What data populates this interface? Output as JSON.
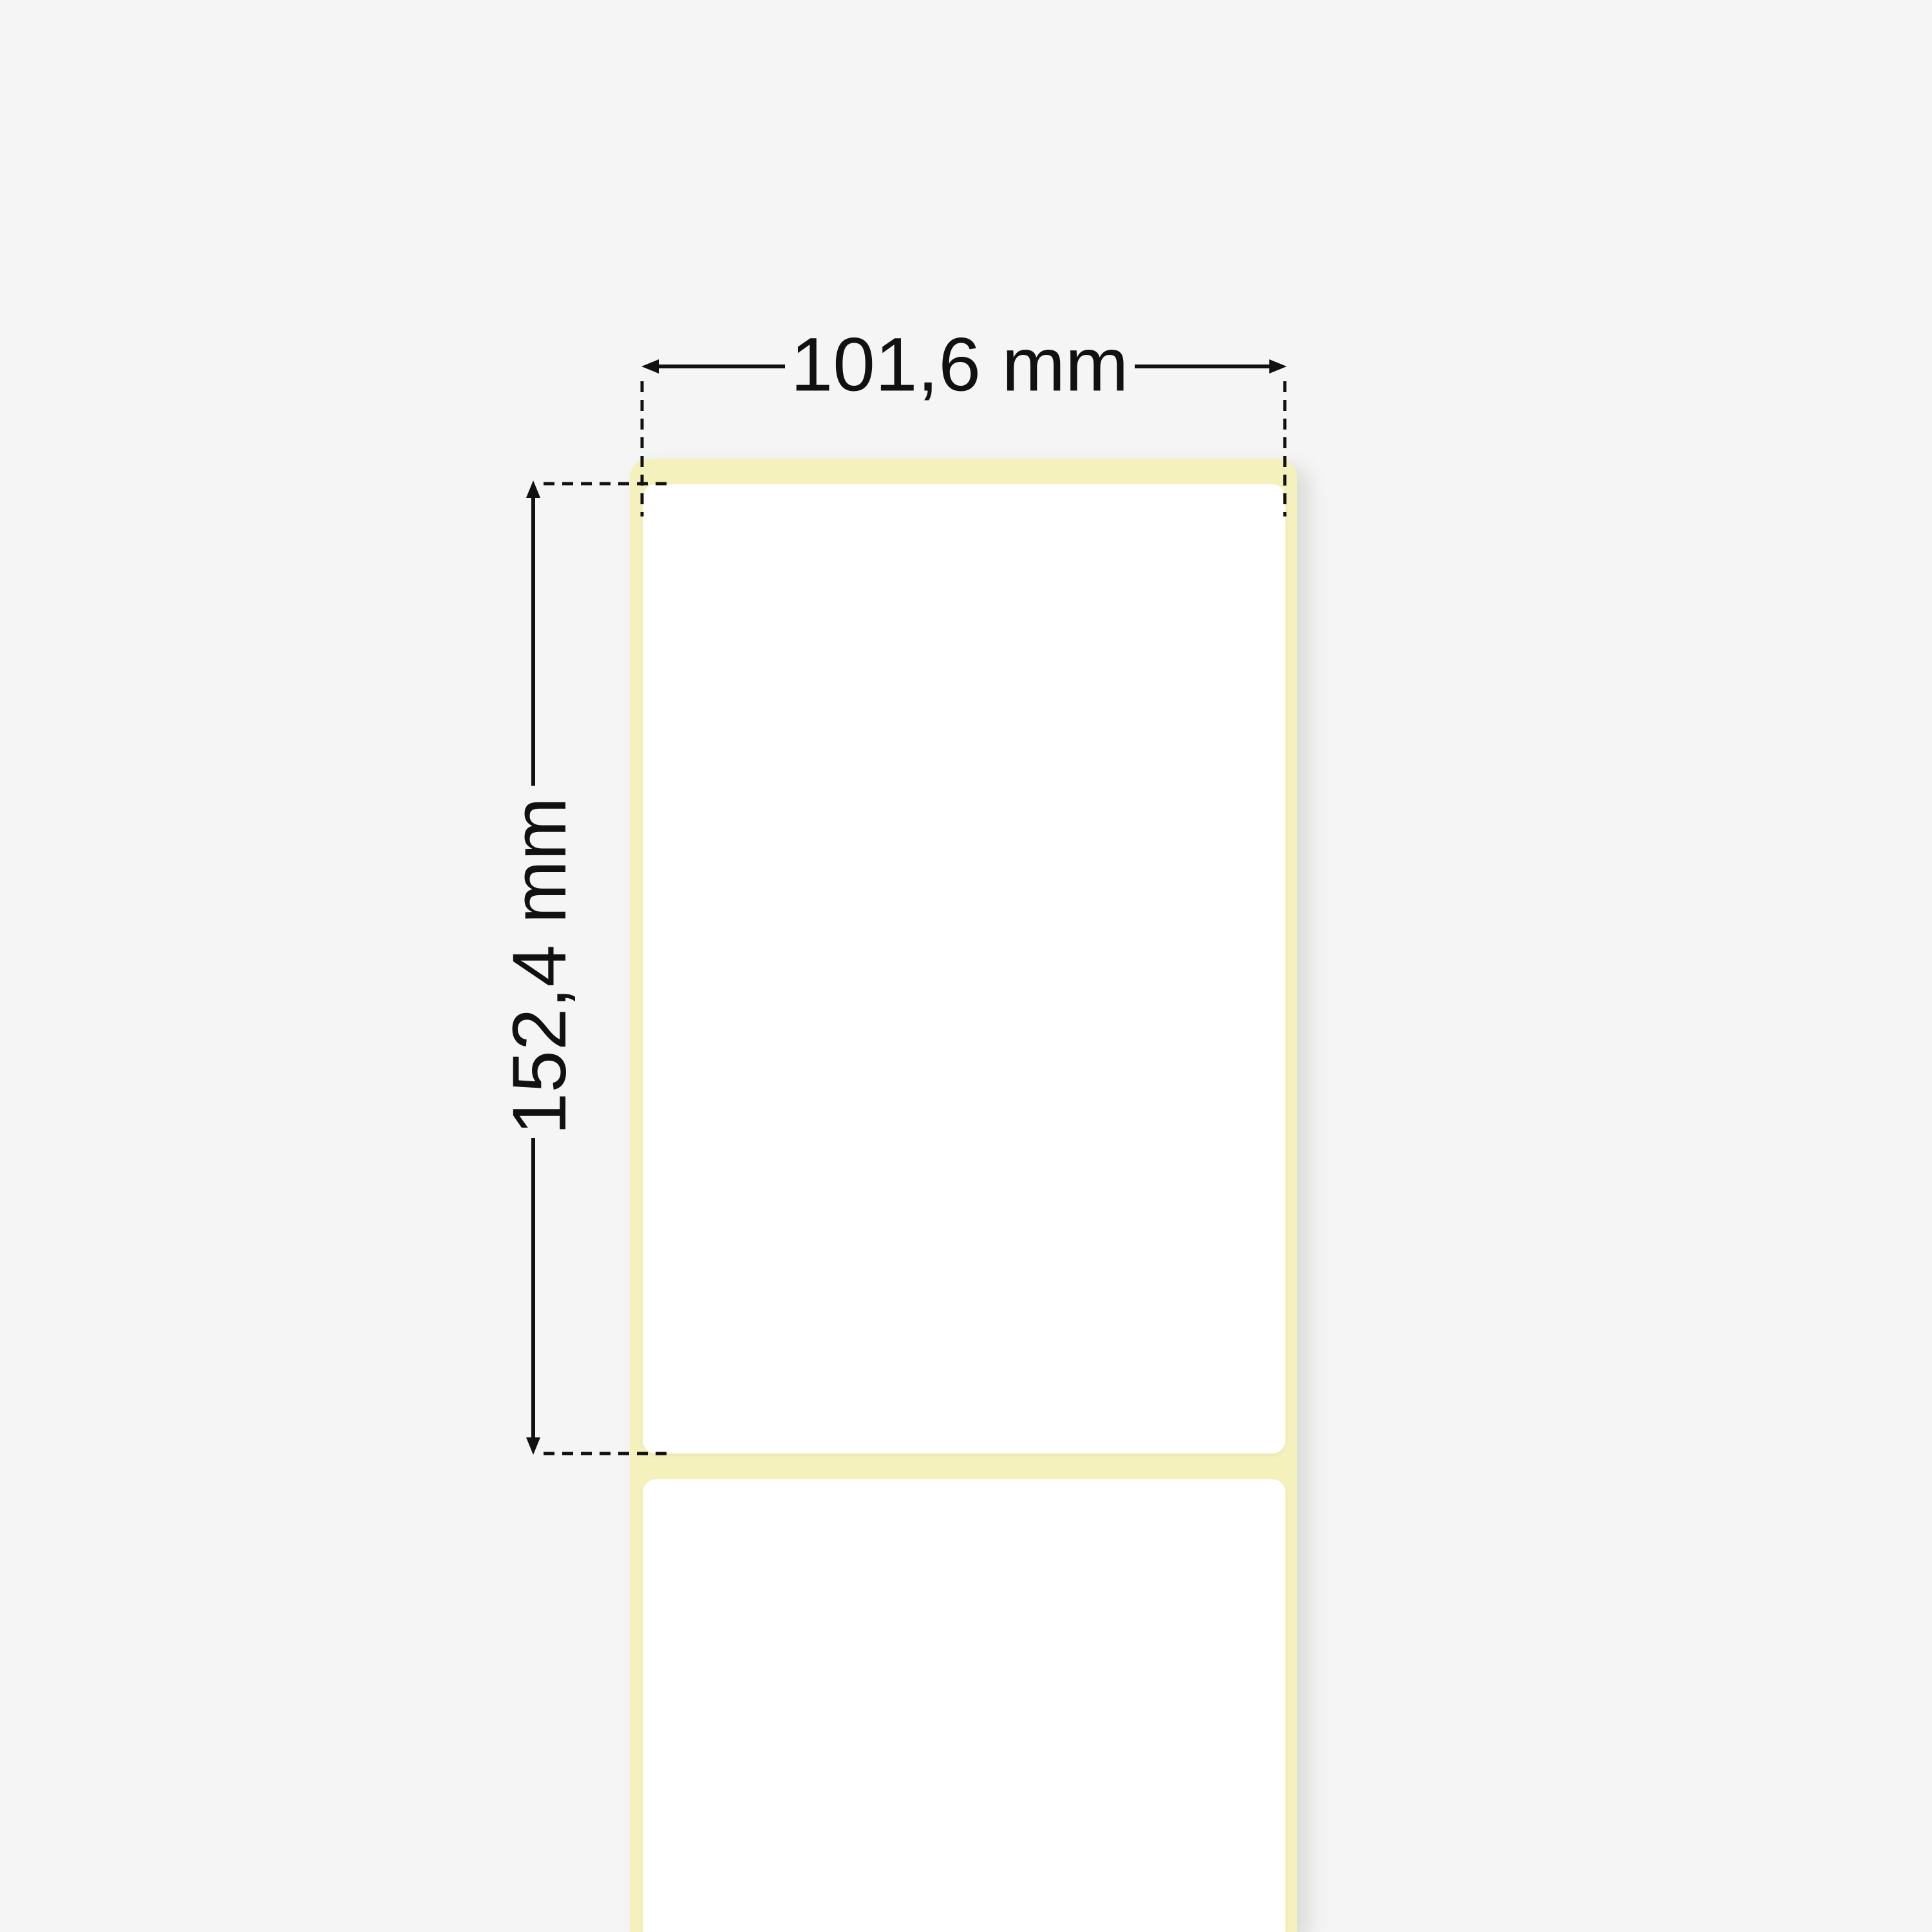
{
  "diagram": {
    "kind": "thermal-label-roll-dimension-diagram",
    "width_label": "101,6 mm",
    "height_label": "152,4 mm"
  },
  "colors": {
    "background": "#f5f5f5",
    "liner": "#f5f1bc",
    "label": "#ffffff",
    "ink": "#111111"
  }
}
